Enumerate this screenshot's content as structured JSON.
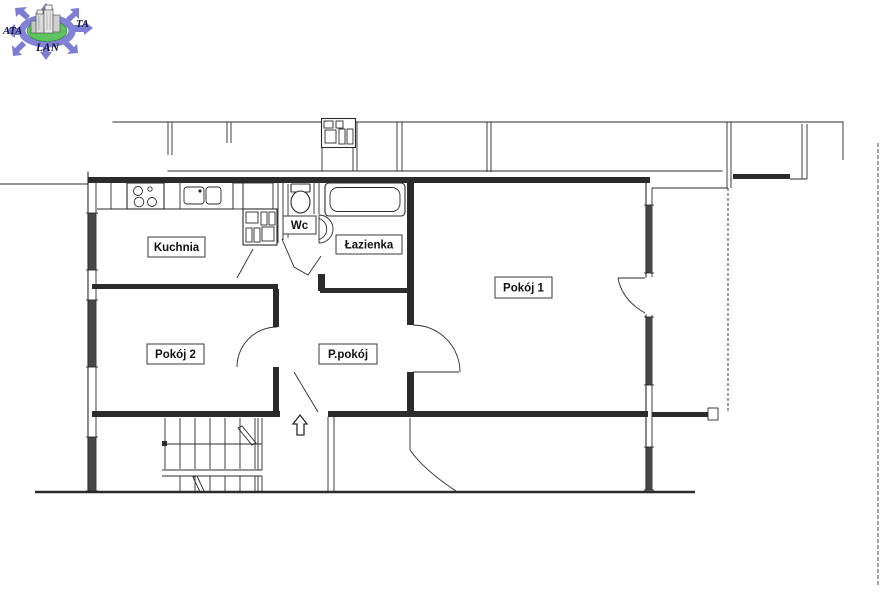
{
  "page": {
    "background": "#ffffff",
    "ink_color": "#2b2b2b",
    "window_fill": "#474747"
  },
  "logo": {
    "text_left": "ATA",
    "text_right": "TA",
    "text_bottom": "LAN",
    "arrow_color": "#7d7dd4",
    "ring_color": "#8282d8",
    "center_color": "#5ec45f",
    "center_outline": "#2e7d32",
    "building_color": "#d9d9d9",
    "building_edge": "#5a5a5a",
    "text_color": "#16163e"
  },
  "floor_plan": {
    "rooms": [
      {
        "id": "kuchnia",
        "label": "Kuchnia"
      },
      {
        "id": "wc",
        "label": "Wc"
      },
      {
        "id": "lazienka",
        "label": "Łazienka"
      },
      {
        "id": "pokoj1",
        "label": "Pokój 1"
      },
      {
        "id": "pokoj2",
        "label": "Pokój 2"
      },
      {
        "id": "ppokoj",
        "label": "P.pokój"
      }
    ]
  }
}
